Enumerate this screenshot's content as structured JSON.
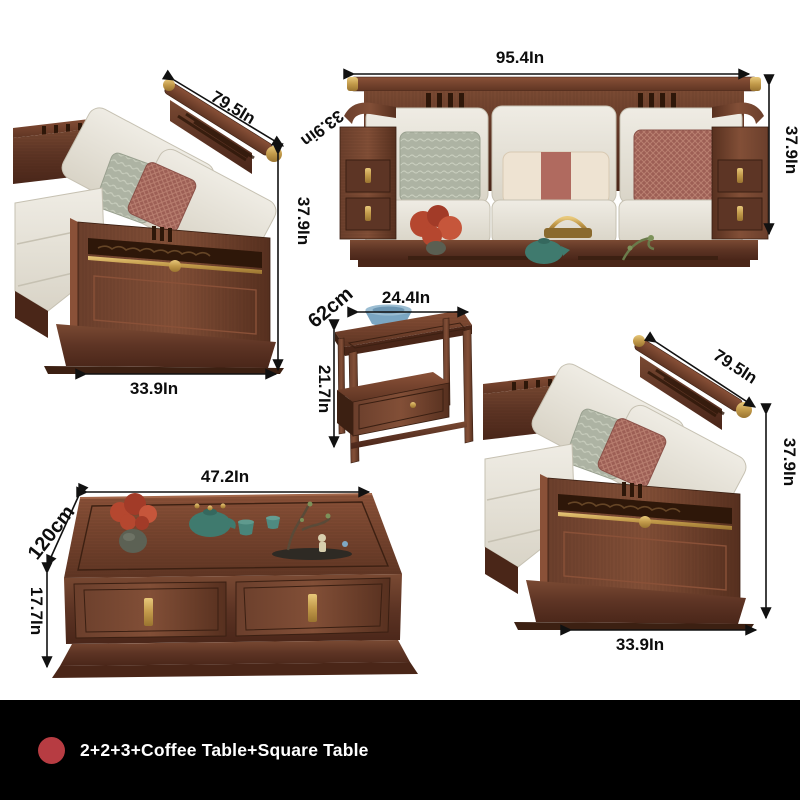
{
  "page": {
    "background": "#ffffff"
  },
  "annotations": {
    "loveseat_a": {
      "rail_length": "79.5In",
      "height": "37.9In",
      "width": "33.9In"
    },
    "sofa_3seat": {
      "width": "95.4In",
      "depth": "33.9in",
      "height": "37.9In"
    },
    "square_table": {
      "top_width": "24.4In",
      "total_height_cm": "62cm",
      "height_in": "21.7In"
    },
    "loveseat_b": {
      "rail_length": "79.5In",
      "height": "37.9In",
      "width": "33.9In"
    },
    "coffee_table": {
      "top_length": "47.2In",
      "length_cm": "120cm",
      "height": "17.7In"
    }
  },
  "caption": {
    "text": "2+2+3+Coffee Table+Square Table",
    "bullet_color": "#b73c42",
    "bar_color": "#000000",
    "text_color": "#ffffff"
  },
  "palette": {
    "wood_dark": "#4a2618",
    "wood_mid": "#5d3424",
    "wood_light": "#8a5138",
    "gold": "#c29a4a",
    "cushion": "#e9e5da",
    "pillow_green": "#adb3a3",
    "pillow_red": "#9d5f55",
    "pillow_stripe": "#b06a5f",
    "teal": "#3f7a6e",
    "bowl_blue": "#7ba6c2",
    "plant_red": "#b5472f",
    "arrow": "#111111"
  }
}
